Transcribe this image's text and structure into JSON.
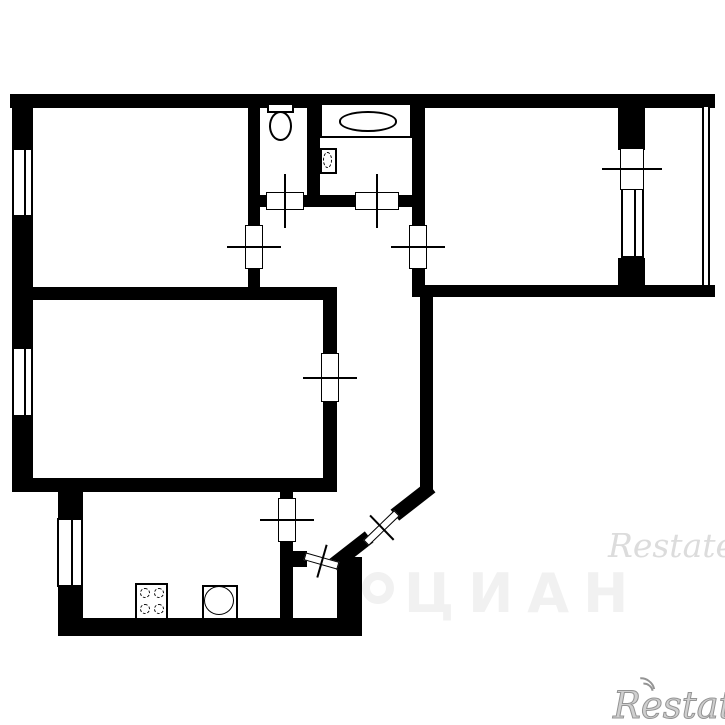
{
  "meta": {
    "description": "Black and white BTI-style apartment floor plan, 3 rooms with kitchen, bathroom, WC, hallway and balcony"
  },
  "colors": {
    "wall": "#000000",
    "background": "#ffffff",
    "watermark_light": "#f1f1f1",
    "watermark_gray": "#dcdcdc",
    "watermark_outline": "#949494"
  },
  "watermarks": {
    "cian_text": "ЦИАН",
    "restate_mid": "Restate",
    "restate_bottom": "Restate"
  },
  "plan": {
    "walls": [
      {
        "name": "outer-top",
        "r": [
          10,
          94,
          705,
          14
        ]
      },
      {
        "name": "outer-left-a",
        "r": [
          12,
          94,
          21,
          54
        ]
      },
      {
        "name": "outer-left-b",
        "r": [
          12,
          217,
          21,
          130
        ]
      },
      {
        "name": "outer-left-c",
        "r": [
          12,
          417,
          21,
          75
        ]
      },
      {
        "name": "mid-horizontal",
        "r": [
          12,
          287,
          325,
          13
        ]
      },
      {
        "name": "living-bottom",
        "r": [
          12,
          478,
          325,
          14
        ]
      },
      {
        "name": "room1-right-a",
        "r": [
          248,
          107,
          12,
          120
        ]
      },
      {
        "name": "room1-right-b",
        "r": [
          248,
          267,
          12,
          20
        ]
      },
      {
        "name": "wc-bath-divider",
        "r": [
          307,
          107,
          13,
          88
        ]
      },
      {
        "name": "wc-front-a",
        "r": [
          248,
          195,
          20,
          12
        ]
      },
      {
        "name": "wc-front-b",
        "r": [
          302,
          195,
          55,
          12
        ]
      },
      {
        "name": "wc-front-c",
        "r": [
          397,
          195,
          15,
          12
        ]
      },
      {
        "name": "room2-left-a",
        "r": [
          412,
          107,
          13,
          120
        ]
      },
      {
        "name": "room2-left-b",
        "r": [
          412,
          267,
          13,
          30
        ]
      },
      {
        "name": "room2-bottom",
        "r": [
          412,
          285,
          303,
          12
        ]
      },
      {
        "name": "balcony-partition-a",
        "r": [
          618,
          107,
          27,
          43
        ]
      },
      {
        "name": "balcony-partition-b",
        "r": [
          618,
          258,
          27,
          27
        ]
      },
      {
        "name": "living-right-a",
        "r": [
          323,
          300,
          14,
          55
        ]
      },
      {
        "name": "living-right-b",
        "r": [
          323,
          400,
          14,
          92
        ]
      },
      {
        "name": "hall-right",
        "r": [
          420,
          297,
          13,
          193
        ]
      },
      {
        "name": "kitchen-left-a",
        "r": [
          58,
          490,
          25,
          28
        ]
      },
      {
        "name": "kitchen-left-b",
        "r": [
          58,
          587,
          25,
          46
        ]
      },
      {
        "name": "outer-bottom",
        "r": [
          58,
          618,
          304,
          18
        ]
      },
      {
        "name": "kitchen-right-a",
        "r": [
          280,
          490,
          13,
          10
        ]
      },
      {
        "name": "kitchen-right-b",
        "r": [
          280,
          540,
          13,
          80
        ]
      },
      {
        "name": "entry-right",
        "r": [
          337,
          557,
          25,
          79
        ]
      },
      {
        "name": "entry-stub",
        "r": [
          293,
          551,
          14,
          16
        ]
      },
      {
        "name": "diagonal-upper",
        "r": [
          390,
          494,
          46,
          14
        ],
        "rot": -38
      },
      {
        "name": "diagonal-lower",
        "r": [
          328,
          544,
          46,
          14
        ],
        "rot": -38
      }
    ],
    "windows": [
      {
        "name": "window-room1",
        "kind": "framed",
        "r": [
          12,
          148,
          21,
          69
        ]
      },
      {
        "name": "window-living",
        "kind": "framed",
        "r": [
          12,
          347,
          21,
          70
        ]
      },
      {
        "name": "window-kitchen",
        "kind": "framed",
        "r": [
          57,
          518,
          26,
          69
        ]
      },
      {
        "name": "window-room2",
        "kind": "framed",
        "r": [
          621,
          188,
          23,
          70
        ]
      },
      {
        "name": "balcony-glazing",
        "kind": "glazing",
        "r": [
          702,
          107,
          8,
          178
        ]
      }
    ],
    "doors": [
      {
        "name": "door-wc",
        "r": [
          266,
          192,
          38,
          18
        ]
      },
      {
        "name": "door-bathroom",
        "r": [
          355,
          192,
          44,
          18
        ]
      },
      {
        "name": "door-room1",
        "r": [
          245,
          225,
          18,
          44
        ]
      },
      {
        "name": "door-room2",
        "r": [
          409,
          225,
          18,
          44
        ]
      },
      {
        "name": "door-living",
        "r": [
          321,
          353,
          18,
          49
        ]
      },
      {
        "name": "door-kitchen",
        "r": [
          278,
          498,
          18,
          44
        ]
      },
      {
        "name": "door-balcony",
        "r": [
          620,
          148,
          24,
          42
        ]
      },
      {
        "name": "door-entry-inner",
        "r": [
          304,
          557,
          35,
          8
        ],
        "rot": 16
      },
      {
        "name": "door-entry-main",
        "r": [
          360,
          524,
          43,
          8
        ],
        "rot": -44
      }
    ],
    "fixtures": [
      {
        "type": "toilet",
        "name": "toilet-icon",
        "r": [
          267,
          103,
          28,
          39
        ]
      },
      {
        "type": "bathtub",
        "name": "bathtub-icon",
        "r": [
          320,
          103,
          92,
          35
        ]
      },
      {
        "type": "sink-bath",
        "name": "bath-sink-icon",
        "r": [
          320,
          148,
          17,
          26
        ]
      },
      {
        "type": "stove",
        "name": "stove-icon",
        "r": [
          135,
          583,
          33,
          37
        ]
      },
      {
        "type": "sink-kitchen",
        "name": "kitchen-sink-icon",
        "r": [
          202,
          585,
          36,
          35
        ]
      }
    ]
  },
  "watermark_layout": {
    "cian_logo": [
      362,
      572,
      30,
      30
    ],
    "cian_text_pos": [
      404,
      562
    ],
    "restate_mid_pos": [
      608,
      526
    ],
    "restate_bottom_pos": [
      613,
      684
    ]
  }
}
